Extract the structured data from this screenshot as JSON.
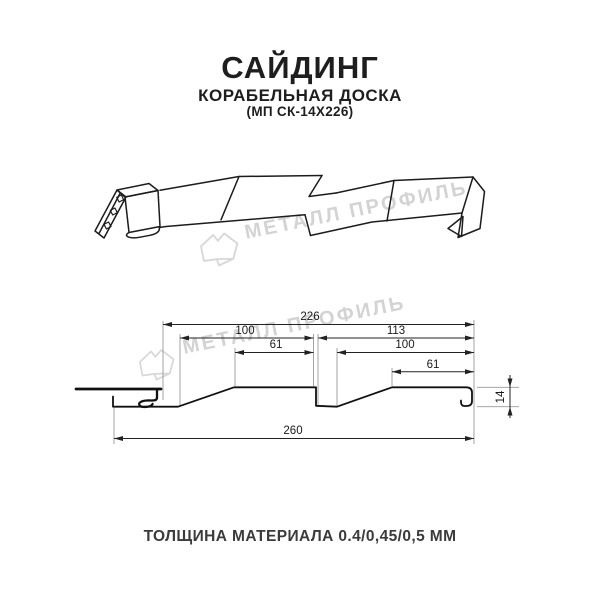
{
  "header": {
    "title": "САЙДИНГ",
    "subtitle": "КОРАБЕЛЬНАЯ ДОСКА",
    "code": "(МП СК-14Х226)"
  },
  "watermark": {
    "brand": "МЕТАЛЛ ПРОФИЛЬ"
  },
  "drawing": {
    "dimensions": {
      "overall_width": "226",
      "left_pitch": "100",
      "right_pitch": "113",
      "left_flat": "61",
      "right_inner": "100",
      "right_flat": "61",
      "total_width": "260",
      "profile_height": "14"
    }
  },
  "footer": {
    "thickness_note": "ТОЛЩИНА МАТЕРИАЛА 0.4/0,45/0,5 ММ"
  },
  "colors": {
    "line": "#1c1c1c",
    "dimension": "#222222",
    "extension": "#999999",
    "watermark": "#d3d3d3"
  }
}
